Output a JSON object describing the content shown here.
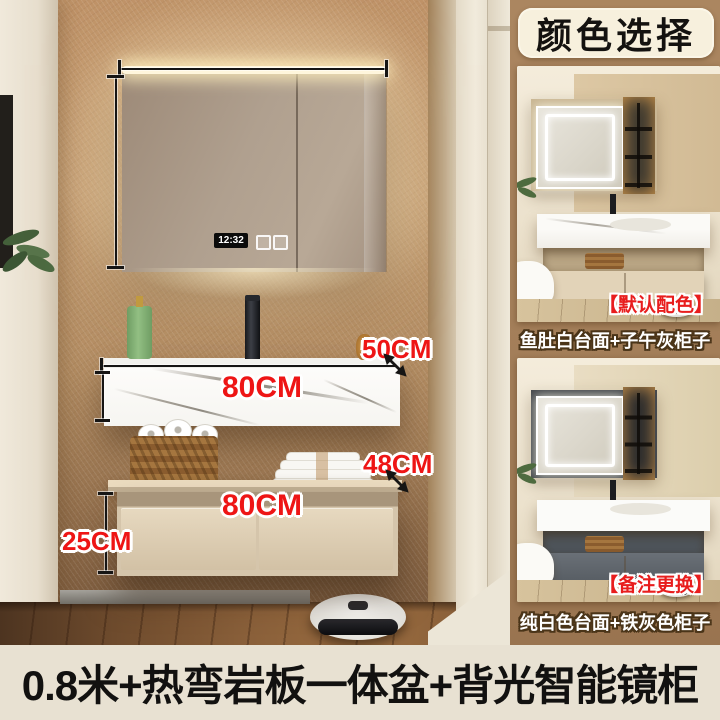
{
  "main_scene": {
    "clock_time": "12:32",
    "dimensions": {
      "counter_depth": "50CM",
      "counter_width": "80CM",
      "cabinet_depth": "48CM",
      "cabinet_width": "80CM",
      "cabinet_height": "25CM"
    }
  },
  "color_panel": {
    "title": "颜色选择",
    "options": [
      {
        "tag": "【默认配色】",
        "caption": "鱼肚白台面+子午灰柜子"
      },
      {
        "tag": "【备注更换】",
        "caption": "纯白色台面+铁灰色柜子"
      }
    ]
  },
  "footer": {
    "title": "0.8米+热弯岩板一体盆+背光智能镜柜"
  },
  "colors": {
    "dimension_label": "#ee1515",
    "tag_red": "#e81d1d",
    "panel_background": "#a6815d",
    "badge_background": "#f7f0dd",
    "footer_background": "#e8e1d2"
  }
}
